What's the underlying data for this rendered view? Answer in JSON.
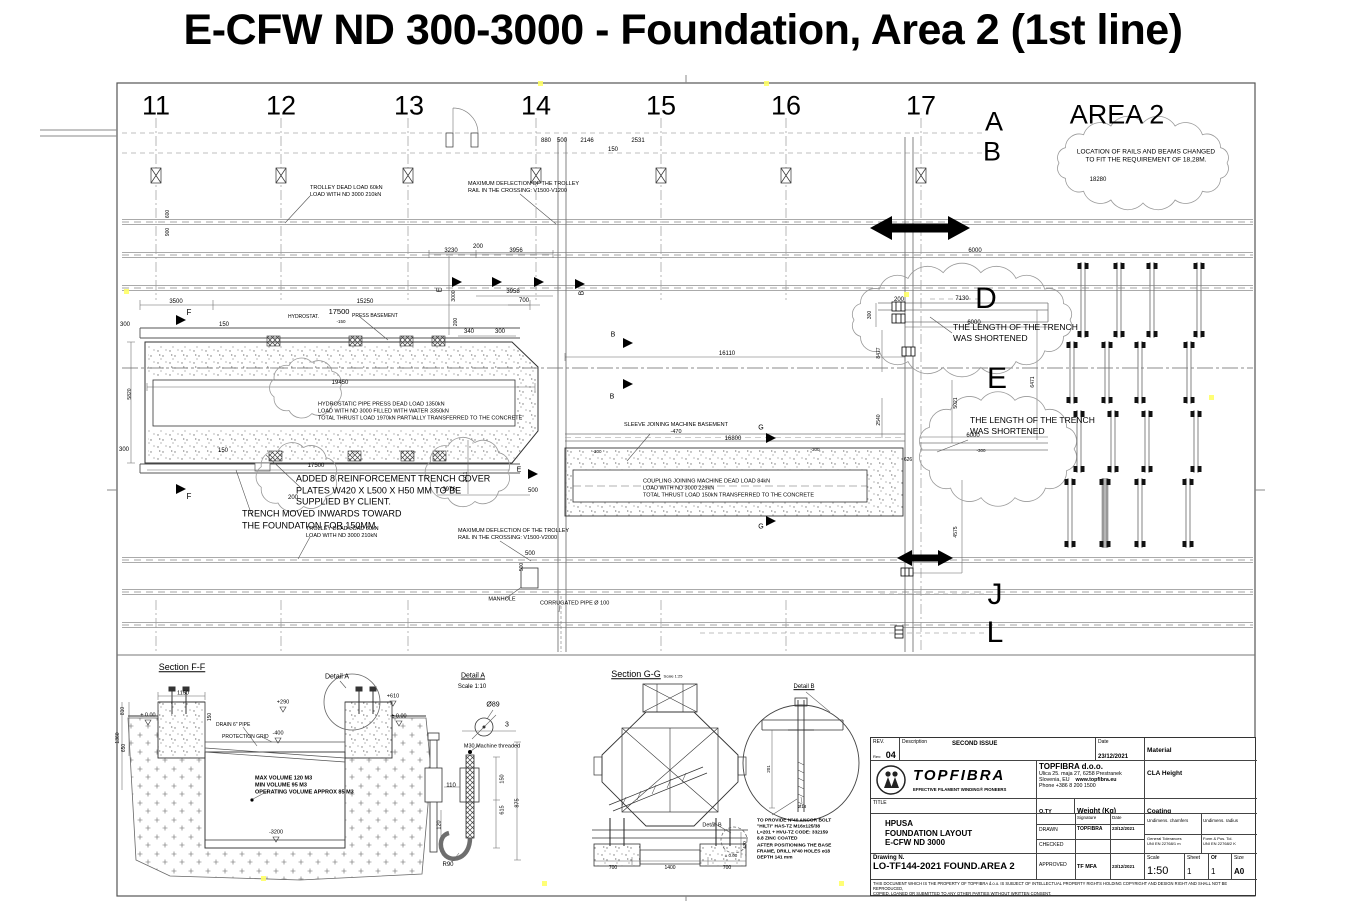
{
  "page_title": "E-CFW ND 300-3000 - Foundation, Area 2 (1st line)",
  "grid": {
    "columns": [
      "11",
      "12",
      "13",
      "14",
      "15",
      "16",
      "17"
    ],
    "rows": [
      "A",
      "B",
      "D",
      "E",
      "J",
      "L"
    ]
  },
  "area2": {
    "label": "AREA 2"
  },
  "annotations": [
    {
      "t": "11",
      "x": 156,
      "y": 106,
      "f": 27,
      "n": "grid-col-11"
    },
    {
      "t": "12",
      "x": 281,
      "y": 106,
      "f": 27,
      "n": "grid-col-12"
    },
    {
      "t": "13",
      "x": 409,
      "y": 106,
      "f": 27,
      "n": "grid-col-13"
    },
    {
      "t": "14",
      "x": 536,
      "y": 106,
      "f": 27,
      "n": "grid-col-14"
    },
    {
      "t": "15",
      "x": 661,
      "y": 106,
      "f": 27,
      "n": "grid-col-15"
    },
    {
      "t": "16",
      "x": 786,
      "y": 106,
      "f": 27,
      "n": "grid-col-16"
    },
    {
      "t": "17",
      "x": 921,
      "y": 106,
      "f": 27,
      "n": "grid-col-17"
    },
    {
      "t": "A",
      "x": 994,
      "y": 122,
      "f": 27,
      "n": "grid-row-A"
    },
    {
      "t": "B",
      "x": 992,
      "y": 152,
      "f": 27,
      "n": "grid-row-B"
    },
    {
      "t": "D",
      "x": 986,
      "y": 299,
      "f": 30,
      "n": "grid-row-D"
    },
    {
      "t": "E",
      "x": 997,
      "y": 379,
      "f": 30,
      "n": "grid-row-E"
    },
    {
      "t": "J",
      "x": 995,
      "y": 595,
      "f": 30,
      "n": "grid-row-J"
    },
    {
      "t": "L",
      "x": 995,
      "y": 633,
      "f": 30,
      "n": "grid-row-L"
    },
    {
      "t": "AREA 2",
      "x": 1117,
      "y": 115,
      "f": 27,
      "n": "area2-label"
    },
    {
      "t": "LOCATION OF RAILS AND BEAMS CHANGED\nTO FIT THE REQUIREMENT OF 18,28M.",
      "x": 1146,
      "y": 157,
      "f": 6.5,
      "n": "note-area2"
    },
    {
      "t": "18280",
      "x": 1098,
      "y": 181,
      "f": 6,
      "n": "dim"
    },
    {
      "t": "THE LENGTH OF THE TRENCH\nWAS SHORTENED",
      "x": 953,
      "y": 333,
      "f": 8.5,
      "c": "l",
      "n": "note-trench-shortened-1"
    },
    {
      "t": "THE LENGTH OF THE TRENCH\nWAS SHORTENED",
      "x": 970,
      "y": 426,
      "f": 8.5,
      "c": "l",
      "n": "note-trench-shortened-2"
    },
    {
      "t": "TROLLEY DEAD LOAD 60kN\nLOAD WITH ND 3000 210kN",
      "x": 310,
      "y": 192,
      "f": 5.5,
      "c": "l",
      "n": "note-trolley-top"
    },
    {
      "t": "MAXIMUM DEFLECTION OF THE TROLLEY\nRAIL IN THE CROSSING: V1500-V1200",
      "x": 468,
      "y": 188,
      "f": 5.5,
      "c": "l",
      "n": "note-deflection-top"
    },
    {
      "t": "HYDROSTAT.",
      "x": 288,
      "y": 317,
      "f": 5,
      "c": "l",
      "n": "note-hydrostat"
    },
    {
      "t": "17500",
      "x": 339,
      "y": 312,
      "f": 7.5,
      "n": "dim"
    },
    {
      "t": "PRESS BASEMENT",
      "x": 352,
      "y": 316,
      "f": 5,
      "c": "l",
      "n": "note-press-basement"
    },
    {
      "t": "-150",
      "x": 341,
      "y": 322,
      "f": 4.5,
      "n": "dim"
    },
    {
      "t": "HYDROSTATIC PIPE PRESS DEAD LOAD 1350kN\nLOAD WITH ND 3000 FILLED WITH WATER 3350kN\nTOTAL THRUST LOAD 1970kN PARTIALLY TRANSFERRED TO THE CONCRETE",
      "x": 318,
      "y": 412,
      "f": 5.5,
      "c": "l",
      "n": "note-press-load"
    },
    {
      "t": "ADDED 8 REINFORCEMENT TRENCH COVER\nPLATES W420 X L500 X H50 MM TO BE\nSUPPLIED BY CLIENT.",
      "x": 296,
      "y": 491,
      "f": 9,
      "c": "l",
      "n": "note-cover-plates"
    },
    {
      "t": "TRENCH MOVED INWARDS TOWARD\nTHE FOUNDATION FOR 150MM.",
      "x": 242,
      "y": 520,
      "f": 9,
      "c": "l",
      "n": "note-trench-moved"
    },
    {
      "t": "TROLLEY DEAD LOAD 60kN\nLOAD WITH ND 3000 210kN",
      "x": 306,
      "y": 533,
      "f": 5.5,
      "c": "l",
      "n": "note-trolley-bottom"
    },
    {
      "t": "MAXIMUM DEFLECTION OF THE TROLLEY\nRAIL IN THE CROSSING: V1500-V2000",
      "x": 458,
      "y": 535,
      "f": 5.5,
      "c": "l",
      "n": "note-deflection-bottom"
    },
    {
      "t": "MANHOLE",
      "x": 502,
      "y": 600,
      "f": 5.5,
      "n": "note-manhole"
    },
    {
      "t": "CORRUGATED PIPE Ø 100",
      "x": 540,
      "y": 604,
      "f": 5.5,
      "c": "l",
      "n": "note-corrugated-pipe"
    },
    {
      "t": "SLEEVE JOINING MACHINE BASEMENT\n-470",
      "x": 676,
      "y": 429,
      "f": 5.5,
      "n": "note-sleeve"
    },
    {
      "t": "COUPLING JOINING MACHINE DEAD LOAD 84kN\nLOAD WITH ND 3000 229kN\nTOTAL THRUST LOAD 150kN TRANSFERRED TO THE CONCRETE",
      "x": 643,
      "y": 489,
      "f": 5.5,
      "c": "l",
      "n": "note-coupling-load"
    },
    {
      "t": "880",
      "x": 546,
      "y": 142,
      "f": 6,
      "n": "dim"
    },
    {
      "t": "500",
      "x": 562,
      "y": 142,
      "f": 6,
      "n": "dim"
    },
    {
      "t": "2146",
      "x": 587,
      "y": 142,
      "f": 6,
      "n": "dim"
    },
    {
      "t": "150",
      "x": 613,
      "y": 151,
      "f": 6,
      "n": "dim"
    },
    {
      "t": "2531",
      "x": 638,
      "y": 142,
      "f": 6,
      "n": "dim"
    },
    {
      "t": "3500",
      "x": 176,
      "y": 303,
      "f": 6,
      "n": "dim"
    },
    {
      "t": "15250",
      "x": 365,
      "y": 303,
      "f": 6,
      "n": "dim"
    },
    {
      "t": "300",
      "x": 125,
      "y": 326,
      "f": 6,
      "n": "dim"
    },
    {
      "t": "150",
      "x": 224,
      "y": 326,
      "f": 6,
      "n": "dim"
    },
    {
      "t": "3230",
      "x": 451,
      "y": 252,
      "f": 6,
      "n": "dim"
    },
    {
      "t": "200",
      "x": 478,
      "y": 248,
      "f": 6,
      "n": "dim"
    },
    {
      "t": "3956",
      "x": 516,
      "y": 252,
      "f": 6,
      "n": "dim"
    },
    {
      "t": "3958",
      "x": 513,
      "y": 293,
      "f": 6,
      "n": "dim"
    },
    {
      "t": "700",
      "x": 524,
      "y": 302,
      "f": 6,
      "n": "dim"
    },
    {
      "t": "3000",
      "x": 454,
      "y": 296,
      "f": 5,
      "c": "r",
      "n": "dim"
    },
    {
      "t": "200",
      "x": 456,
      "y": 322,
      "f": 5,
      "c": "r",
      "n": "dim"
    },
    {
      "t": "340",
      "x": 469,
      "y": 333,
      "f": 6,
      "n": "dim"
    },
    {
      "t": "300",
      "x": 500,
      "y": 333,
      "f": 6,
      "n": "dim"
    },
    {
      "t": "19450",
      "x": 340,
      "y": 384,
      "f": 6,
      "n": "dim"
    },
    {
      "t": "5820",
      "x": 130,
      "y": 394,
      "f": 5,
      "c": "r",
      "n": "dim"
    },
    {
      "t": "16110",
      "x": 727,
      "y": 355,
      "f": 6,
      "n": "dim"
    },
    {
      "t": "17500",
      "x": 316,
      "y": 467,
      "f": 6,
      "n": "dim"
    },
    {
      "t": "150",
      "x": 223,
      "y": 452,
      "f": 6,
      "n": "dim"
    },
    {
      "t": "300",
      "x": 124,
      "y": 451,
      "f": 6,
      "n": "dim"
    },
    {
      "t": "2011",
      "x": 466,
      "y": 477,
      "f": 5,
      "c": "r",
      "n": "dim"
    },
    {
      "t": "3976",
      "x": 449,
      "y": 491,
      "f": 6,
      "n": "dim"
    },
    {
      "t": "500",
      "x": 533,
      "y": 492,
      "f": 6,
      "n": "dim"
    },
    {
      "t": "200",
      "x": 293,
      "y": 499,
      "f": 6,
      "n": "dim"
    },
    {
      "t": "16800",
      "x": 733,
      "y": 440,
      "f": 6,
      "n": "dim"
    },
    {
      "t": "-300",
      "x": 597,
      "y": 452,
      "f": 4.5,
      "n": "dim"
    },
    {
      "t": "-300",
      "x": 815,
      "y": 450,
      "f": 4.5,
      "n": "dim"
    },
    {
      "t": "200",
      "x": 899,
      "y": 301,
      "f": 6,
      "n": "dim"
    },
    {
      "t": "7130",
      "x": 962,
      "y": 300,
      "f": 6,
      "n": "dim"
    },
    {
      "t": "6000",
      "x": 974,
      "y": 324,
      "f": 6,
      "n": "dim"
    },
    {
      "t": "300",
      "x": 870,
      "y": 315,
      "f": 5,
      "c": "r",
      "n": "dim"
    },
    {
      "t": "8477",
      "x": 879,
      "y": 353,
      "f": 5,
      "c": "r",
      "n": "dim"
    },
    {
      "t": "5021",
      "x": 956,
      "y": 403,
      "f": 5,
      "c": "r",
      "n": "dim"
    },
    {
      "t": "6471",
      "x": 1033,
      "y": 382,
      "f": 5,
      "c": "r",
      "n": "dim"
    },
    {
      "t": "2540",
      "x": 879,
      "y": 420,
      "f": 5,
      "c": "r",
      "n": "dim"
    },
    {
      "t": "626",
      "x": 908,
      "y": 460,
      "f": 5,
      "n": "dim"
    },
    {
      "t": "6000",
      "x": 973,
      "y": 437,
      "f": 6,
      "n": "dim"
    },
    {
      "t": "-300",
      "x": 981,
      "y": 451,
      "f": 4.5,
      "n": "dim"
    },
    {
      "t": "6000",
      "x": 975,
      "y": 252,
      "f": 6,
      "n": "dim"
    },
    {
      "t": "4575",
      "x": 956,
      "y": 532,
      "f": 5,
      "c": "r",
      "n": "dim"
    },
    {
      "t": "500",
      "x": 530,
      "y": 555,
      "f": 6,
      "n": "dim"
    },
    {
      "t": "500",
      "x": 522,
      "y": 567,
      "f": 5,
      "c": "r",
      "n": "dim"
    },
    {
      "t": "600",
      "x": 168,
      "y": 214,
      "f": 5,
      "c": "r",
      "n": "dim"
    },
    {
      "t": "900",
      "x": 168,
      "y": 232,
      "f": 5,
      "c": "r",
      "n": "dim"
    },
    {
      "t": "F",
      "x": 189,
      "y": 313,
      "f": 8,
      "n": "section-letter-F"
    },
    {
      "t": "F",
      "x": 189,
      "y": 497,
      "f": 8,
      "n": "section-letter-F"
    },
    {
      "t": "E",
      "x": 441,
      "y": 290,
      "f": 7,
      "c": "r",
      "n": "section-letter-E"
    },
    {
      "t": "B",
      "x": 583,
      "y": 293,
      "f": 7,
      "c": "r",
      "n": "section-letter-B"
    },
    {
      "t": "B",
      "x": 613,
      "y": 336,
      "f": 7,
      "n": "section-letter-B"
    },
    {
      "t": "B",
      "x": 612,
      "y": 398,
      "f": 7,
      "n": "section-letter-B"
    },
    {
      "t": "G",
      "x": 761,
      "y": 429,
      "f": 7,
      "n": "section-letter-G"
    },
    {
      "t": "G",
      "x": 761,
      "y": 528,
      "f": 7,
      "n": "section-letter-G"
    },
    {
      "t": "E",
      "x": 519,
      "y": 471,
      "f": 7,
      "n": "section-letter-E"
    },
    {
      "t": "Section  F-F",
      "x": 182,
      "y": 668,
      "f": 9,
      "c": "u",
      "n": "section-ff-title"
    },
    {
      "t": "Detail A",
      "x": 337,
      "y": 678,
      "f": 7,
      "n": "detail-a-callout"
    },
    {
      "t": "1150",
      "x": 183,
      "y": 694,
      "f": 5.5,
      "n": "dim"
    },
    {
      "t": "+290",
      "x": 283,
      "y": 703,
      "f": 5.5,
      "n": "dim"
    },
    {
      "t": "± 0.00",
      "x": 148,
      "y": 716,
      "f": 5.5,
      "n": "dim"
    },
    {
      "t": "± 0.00",
      "x": 399,
      "y": 717,
      "f": 5.5,
      "n": "dim"
    },
    {
      "t": "+610",
      "x": 393,
      "y": 697,
      "f": 5.5,
      "n": "dim"
    },
    {
      "t": "-400",
      "x": 278,
      "y": 734,
      "f": 5.5,
      "n": "dim"
    },
    {
      "t": "150",
      "x": 210,
      "y": 717,
      "f": 5,
      "c": "r",
      "n": "dim"
    },
    {
      "t": "810",
      "x": 123,
      "y": 711,
      "f": 5,
      "c": "r",
      "n": "dim"
    },
    {
      "t": "1360",
      "x": 118,
      "y": 738,
      "f": 5,
      "c": "r",
      "n": "dim"
    },
    {
      "t": "650",
      "x": 124,
      "y": 748,
      "f": 5,
      "c": "r",
      "n": "dim"
    },
    {
      "t": "-3200",
      "x": 276,
      "y": 833,
      "f": 5.5,
      "n": "dim"
    },
    {
      "t": "DRAIN 6\" PIPE",
      "x": 216,
      "y": 725,
      "f": 5,
      "c": "l",
      "n": "note-drain-pipe"
    },
    {
      "t": "PROTECTION GRID",
      "x": 222,
      "y": 737,
      "f": 5,
      "c": "l",
      "n": "note-protection-grid"
    },
    {
      "t": "MAX VOLUME 120 M3\nMIN VOLUME 95 M3\nOPERATING VOLUME APPROX 85 M3",
      "x": 255,
      "y": 786,
      "f": 5.5,
      "c": "l b",
      "n": "note-volume"
    },
    {
      "t": "Detail A",
      "x": 473,
      "y": 677,
      "f": 7,
      "c": "u",
      "n": "detail-a-title"
    },
    {
      "t": "Scale 1:10",
      "x": 472,
      "y": 688,
      "f": 6,
      "n": "detail-a-scale"
    },
    {
      "t": "Ø89",
      "x": 493,
      "y": 706,
      "f": 7,
      "n": "dim"
    },
    {
      "t": "3",
      "x": 507,
      "y": 726,
      "f": 7,
      "n": "dim"
    },
    {
      "t": "M30 Machine threaded",
      "x": 492,
      "y": 747,
      "f": 5.5,
      "n": "note-m30"
    },
    {
      "t": "110",
      "x": 451,
      "y": 787,
      "f": 6,
      "n": "dim"
    },
    {
      "t": "150",
      "x": 503,
      "y": 779,
      "f": 5.5,
      "c": "r",
      "n": "dim"
    },
    {
      "t": "615",
      "x": 503,
      "y": 810,
      "f": 5.5,
      "c": "r",
      "n": "dim"
    },
    {
      "t": "875",
      "x": 518,
      "y": 803,
      "f": 5.5,
      "c": "r",
      "n": "dim"
    },
    {
      "t": "120",
      "x": 440,
      "y": 825,
      "f": 5.5,
      "c": "r",
      "n": "dim"
    },
    {
      "t": "R90",
      "x": 448,
      "y": 866,
      "f": 6,
      "n": "dim"
    },
    {
      "t": "Section  G-G",
      "x": 636,
      "y": 675,
      "f": 9,
      "c": "u",
      "n": "section-gg-title"
    },
    {
      "t": "Scale 1:25",
      "x": 673,
      "y": 676,
      "f": 4,
      "n": "section-gg-scale"
    },
    {
      "t": "Detail B",
      "x": 712,
      "y": 826,
      "f": 5.5,
      "n": "detail-b-callout"
    },
    {
      "t": "700",
      "x": 613,
      "y": 868,
      "f": 5,
      "n": "dim"
    },
    {
      "t": "1400",
      "x": 670,
      "y": 868,
      "f": 5,
      "n": "dim"
    },
    {
      "t": "700",
      "x": 727,
      "y": 868,
      "f": 5,
      "n": "dim"
    },
    {
      "t": "470",
      "x": 745,
      "y": 845,
      "f": 4.5,
      "c": "r",
      "n": "dim"
    },
    {
      "t": "± 0.00",
      "x": 731,
      "y": 856,
      "f": 4.5,
      "n": "dim"
    },
    {
      "t": "Detail B",
      "x": 804,
      "y": 688,
      "f": 6,
      "c": "u",
      "n": "detail-b-title"
    },
    {
      "t": "201",
      "x": 769,
      "y": 769,
      "f": 4.5,
      "c": "r",
      "n": "dim"
    },
    {
      "t": "Ø18",
      "x": 802,
      "y": 807,
      "f": 4.5,
      "n": "dim"
    },
    {
      "t": "TO PROVIDE Nº40 ANCOR BOLT\n\"HILTI\" HAS-TZ M16x125/38\nL=201 + HVU-TZ CODE: 332159\n8.8 ZINC COATED\nAFTER POSITIONING THE BASE\nFRAME, DRILL Nº40 HOLES ø18\nDEPTH 141 mm",
      "x": 757,
      "y": 840,
      "f": 4.8,
      "c": "l b",
      "n": "note-anchor-bolt"
    }
  ],
  "title_block": {
    "rev_label": "REV.",
    "rev_small": "Rev:",
    "rev_value": "04",
    "desc_label": "Description",
    "desc_value": "SECOND ISSUE",
    "date_label": "Date",
    "date_value": "23/12/2021",
    "material_label": "Material",
    "company_name": "TOPFIBRA d.o.o.",
    "company_addr1": "Ulica 25. maja 27, 6258 Prestranek",
    "company_addr2": "Slovenia, EU",
    "company_web": "www.topfibra.eu",
    "company_phone": "Phone +386 8 200 1500",
    "cla_label": "CLA Height",
    "title_label": "TITLE",
    "qty_label": "Q.TY",
    "weight_label": "Weight (Kg)",
    "coating_label": "Coating",
    "title_line1": "HPUSA",
    "title_line2": "FOUNDATION LAYOUT",
    "title_line3": "E-CFW ND 3000",
    "signature_label": "Signature",
    "date2_label": "Date",
    "drawn_label": "DRAWN",
    "drawn_sig": "TOPFIBRA",
    "drawn_date": "23/12/2021",
    "checked_label": "CHECKED",
    "approved_label": "APPROVED",
    "approved_sig": "TF MFA",
    "approved_date": "23/12/2021",
    "undim_chamfers": "Undimens. chamfers",
    "undim_radius": "Undimens. radius",
    "gen_tol": "General Tolerances\nUNI EN 22768/1  m",
    "form_tol": "Form & Pos. Tol.\nUNI EN 22768/2  K",
    "drawing_n_label": "Drawing N.",
    "drawing_n_value": "LO-TF144-2021 FOUND.AREA 2",
    "scale_label": "Scale",
    "scale_value": "1:50",
    "sheet_label": "Sheet",
    "sheet_value": "1",
    "of_label": "Of",
    "of_value": "1",
    "size_label": "Size",
    "size_value": "A0",
    "logo_text": "TOPFIBRA",
    "logo_tagline": "EFFECTIVE FILAMENT WINDING® PIONEERS",
    "disclaimer1": "THIS DOCUMENT WHICH IS THE PROPERTY OF TOPFIBRA d.o.o. IS SUBJECT OF INTELLECTUAL PROPERTY RIGHTS HOLDING COPYRIGHT AND DESIGN RIGHT AND SHALL NOT BE REPRODUCED,",
    "disclaimer2": "COPIED, LOANED OR SUBMITTED TO ANY OTHER PARTIES WITHOUT WRITTEN CONSENT."
  }
}
